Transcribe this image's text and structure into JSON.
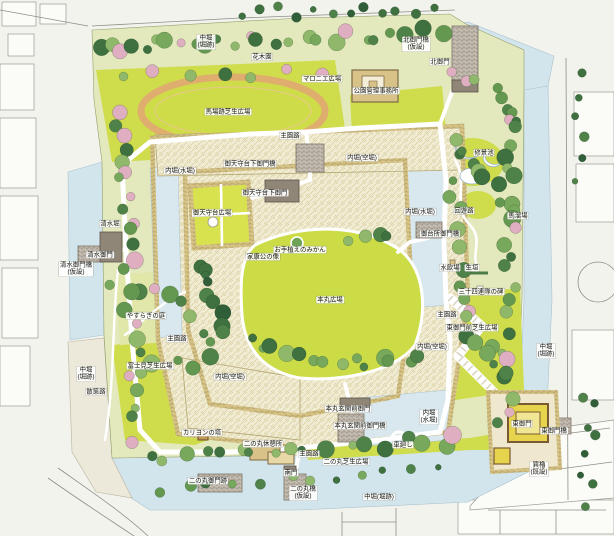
{
  "map": {
    "kind": "illustrated-castle-park-plan",
    "palette": {
      "paper": "#f3f3ee",
      "moat_water": "#d3e5ec",
      "moat_dry": "#ece8da",
      "lawn_bright": "#cfdc4c",
      "park_pale_green": "#e3e9bd",
      "stone_cream": "#f1ecd4",
      "wall_tan": "#d9c687",
      "track_tan": "#dfae6e",
      "tree_dark": "#3e7040",
      "tree_mid": "#649850",
      "tree_light": "#8fb86a",
      "blossom_pink": "#dfaec0",
      "path_white": "#ffffff",
      "street_line": "#8f8f8a",
      "bridge_gray": "#c6beb2"
    },
    "labels": [
      {
        "text": "中堀\n(堀跡)",
        "x": 206,
        "y": 42
      },
      {
        "text": "花木園",
        "x": 262,
        "y": 57
      },
      {
        "text": "マロニエ広場",
        "x": 322,
        "y": 79
      },
      {
        "text": "公園管理事務所",
        "x": 376,
        "y": 91
      },
      {
        "text": "北御門橋\n(仮設)",
        "x": 416,
        "y": 44
      },
      {
        "text": "北御門",
        "x": 440,
        "y": 62
      },
      {
        "text": "馬場跡芝生広場",
        "x": 228,
        "y": 112
      },
      {
        "text": "主園路",
        "x": 290,
        "y": 136
      },
      {
        "text": "修景池",
        "x": 484,
        "y": 153
      },
      {
        "text": "内堀(空堀)",
        "x": 362,
        "y": 158
      },
      {
        "text": "御天守台下御門橋",
        "x": 250,
        "y": 164
      },
      {
        "text": "内堀(水堀)",
        "x": 180,
        "y": 171
      },
      {
        "text": "御天守台下御門",
        "x": 265,
        "y": 193
      },
      {
        "text": "御天守台広場",
        "x": 212,
        "y": 213
      },
      {
        "text": "回遊路",
        "x": 464,
        "y": 211
      },
      {
        "text": "馬溜場",
        "x": 518,
        "y": 216
      },
      {
        "text": "内堀(水堀)",
        "x": 420,
        "y": 212
      },
      {
        "text": "清水堀",
        "x": 110,
        "y": 224
      },
      {
        "text": "御台所御門橋",
        "x": 440,
        "y": 234
      },
      {
        "text": "お手植えのみかん",
        "x": 300,
        "y": 250
      },
      {
        "text": "家康公の像",
        "x": 263,
        "y": 257
      },
      {
        "text": "清水御門",
        "x": 100,
        "y": 255
      },
      {
        "text": "清水御門橋\n(仮設)",
        "x": 76,
        "y": 269
      },
      {
        "text": "水飲場",
        "x": 450,
        "y": 268
      },
      {
        "text": "生垣",
        "x": 472,
        "y": 268
      },
      {
        "text": "三十四連隊の碑",
        "x": 481,
        "y": 292
      },
      {
        "text": "本丸広場",
        "x": 330,
        "y": 300
      },
      {
        "text": "やすらぎの庭",
        "x": 146,
        "y": 316
      },
      {
        "text": "主園路",
        "x": 177,
        "y": 339
      },
      {
        "text": "主園路",
        "x": 447,
        "y": 315
      },
      {
        "text": "東御門前芝生広場",
        "x": 472,
        "y": 328
      },
      {
        "text": "中堀\n(堀跡)",
        "x": 546,
        "y": 351
      },
      {
        "text": "中堀\n(堀跡)",
        "x": 86,
        "y": 374
      },
      {
        "text": "富士見芝生広場",
        "x": 150,
        "y": 366
      },
      {
        "text": "散策路",
        "x": 96,
        "y": 392
      },
      {
        "text": "内堀(空堀)",
        "x": 230,
        "y": 377
      },
      {
        "text": "内堀(空堀)",
        "x": 432,
        "y": 347
      },
      {
        "text": "カリヨンの塔",
        "x": 202,
        "y": 433
      },
      {
        "text": "二の丸休憩所",
        "x": 263,
        "y": 444
      },
      {
        "text": "本丸玄関前御門",
        "x": 348,
        "y": 409
      },
      {
        "text": "本丸玄関前御門橋",
        "x": 360,
        "y": 426
      },
      {
        "text": "内堀\n(水堀)",
        "x": 429,
        "y": 417
      },
      {
        "text": "車廻し",
        "x": 403,
        "y": 445
      },
      {
        "text": "主園路",
        "x": 309,
        "y": 454
      },
      {
        "text": "二の丸芝生広場",
        "x": 346,
        "y": 462
      },
      {
        "text": "南門",
        "x": 291,
        "y": 473
      },
      {
        "text": "二の丸御門跡",
        "x": 208,
        "y": 481
      },
      {
        "text": "二の丸橋\n(仮設)",
        "x": 303,
        "y": 493
      },
      {
        "text": "中堀(堀跡)",
        "x": 379,
        "y": 497
      },
      {
        "text": "東御門",
        "x": 522,
        "y": 424
      },
      {
        "text": "東御門橋",
        "x": 554,
        "y": 431
      },
      {
        "text": "巽櫓\n(既設)",
        "x": 539,
        "y": 469
      }
    ]
  }
}
